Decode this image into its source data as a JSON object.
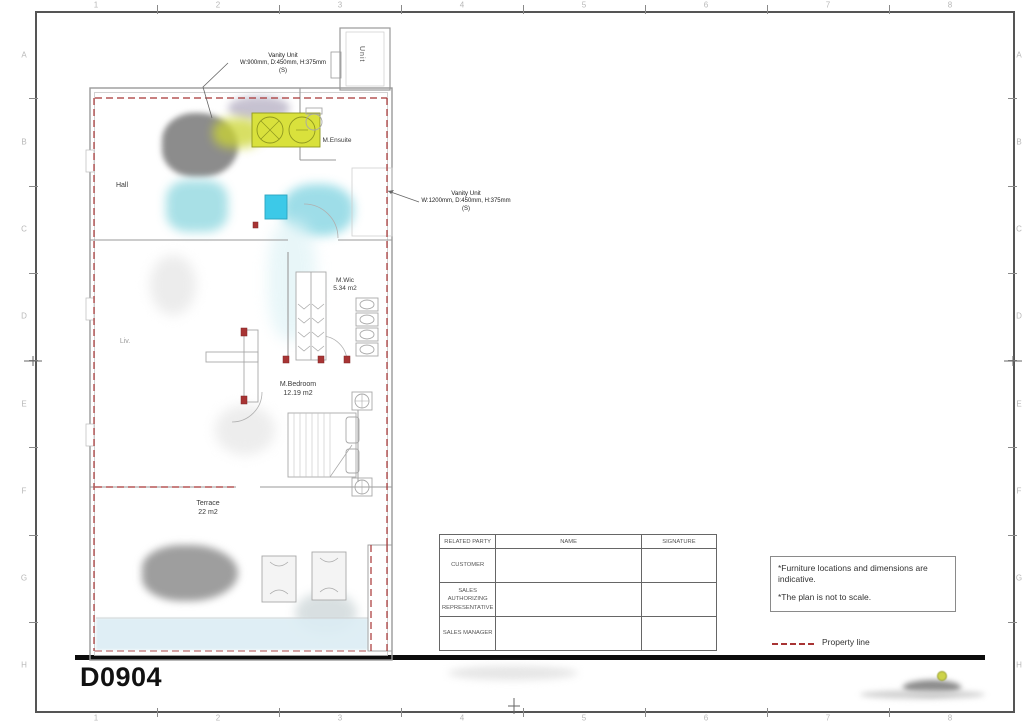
{
  "sheet": {
    "code": "D0904"
  },
  "ruler": {
    "top": [
      "1",
      "2",
      "3",
      "4",
      "5",
      "6",
      "7",
      "8"
    ],
    "bottom": [
      "1",
      "2",
      "3",
      "4",
      "5",
      "6",
      "7",
      "8"
    ],
    "left": [
      "A",
      "B",
      "C",
      "D",
      "E",
      "F",
      "G",
      "H"
    ],
    "right": [
      "A",
      "B",
      "C",
      "D",
      "E",
      "F",
      "G",
      "H"
    ]
  },
  "plan": {
    "rooms": {
      "hall": {
        "name": "Hall"
      },
      "ensuite": {
        "name": "M.Ensuite"
      },
      "wic": {
        "name": "M.Wic",
        "area": "5.34 m2"
      },
      "bedroom": {
        "name": "M.Bedroom",
        "area": "12.19 m2"
      },
      "terrace": {
        "name": "Terrace",
        "area": "22 m2"
      },
      "living": {
        "name": "Liv."
      },
      "shaft": {
        "name": "Unit"
      }
    },
    "annotations": {
      "vanity_top": {
        "title": "Vanity Unit",
        "dims": "W:900mm, D:450mm, H:375mm",
        "qty": "(S)"
      },
      "vanity_right": {
        "title": "Vanity Unit",
        "dims": "W:1200mm, D:450mm, H:375mm",
        "qty": "(S)"
      }
    }
  },
  "signature_table": {
    "headers": [
      "RELATED PARTY",
      "NAME",
      "SIGNATURE"
    ],
    "rows": [
      "CUSTOMER",
      "SALES AUTHORIZING REPRESENTATIVE",
      "SALES MANAGER"
    ]
  },
  "notes": {
    "lines": [
      "*Furniture locations and dimensions are indicative.",
      "*The plan is not to scale."
    ]
  },
  "legend": {
    "property_line": "Property line"
  },
  "colors": {
    "property_line": "#a83434",
    "vanity_fill": "#d9e13c",
    "vanity_stroke": "#8e971f",
    "cyan_fill": "#3cc9e8",
    "wall": "#9a9a9a",
    "frame": "#555555"
  }
}
